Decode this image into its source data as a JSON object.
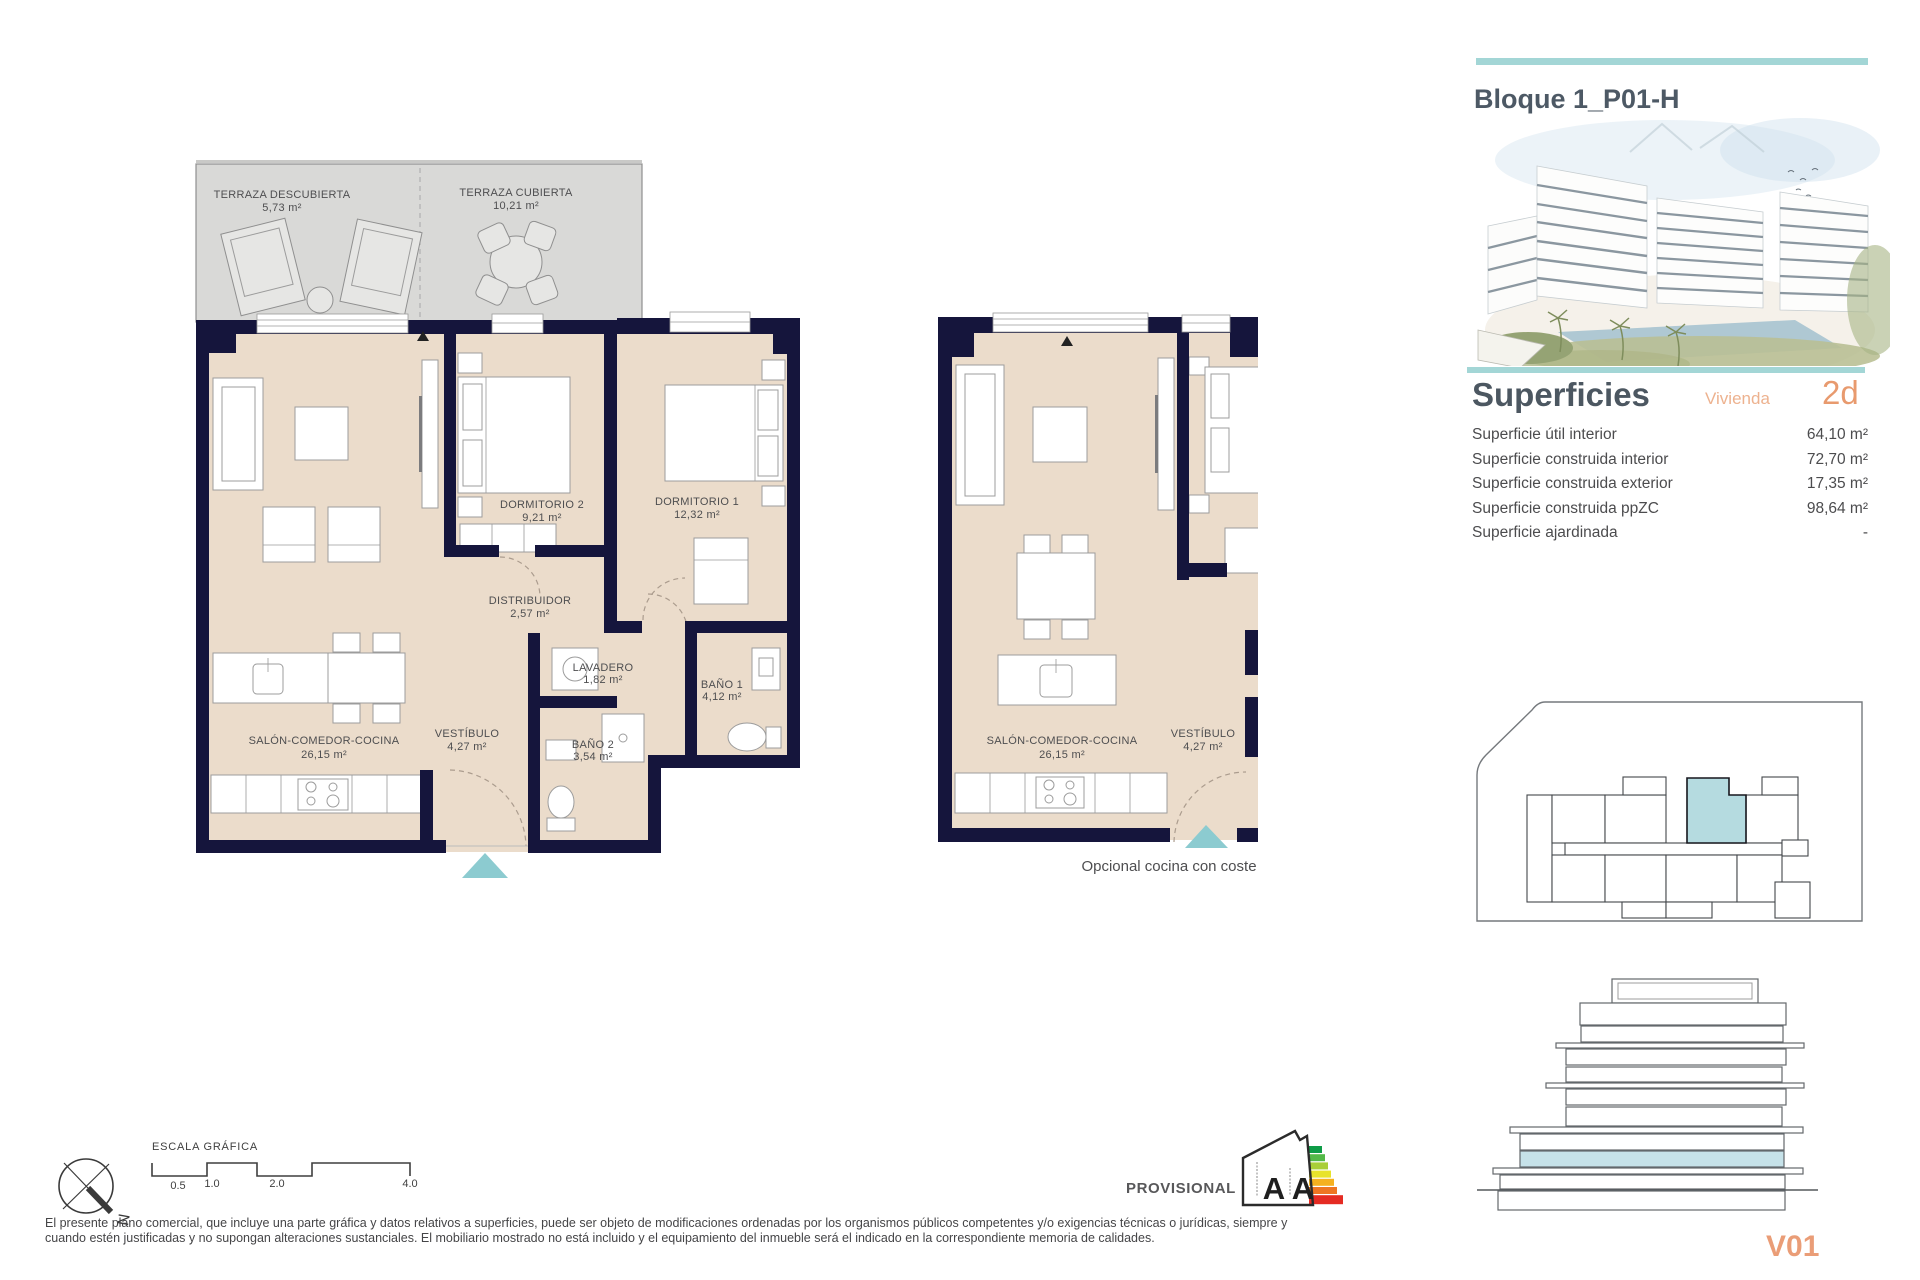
{
  "header": {
    "title": "Bloque 1_P01-H"
  },
  "superficies": {
    "title": "Superficies",
    "vivienda_label": "Vivienda",
    "vivienda_code": "2d",
    "rows": [
      {
        "label": "Superficie útil interior",
        "value": "64,10 m²"
      },
      {
        "label": "Superficie construida interior",
        "value": "72,70 m²"
      },
      {
        "label": "Superficie construida exterior",
        "value": "17,35 m²"
      },
      {
        "label": "Superficie construida ppZC",
        "value": "98,64 m²"
      },
      {
        "label": "Superficie ajardinada",
        "value": "-"
      }
    ]
  },
  "plan_main": {
    "terraza_descubierta": {
      "name": "TERRAZA DESCUBIERTA",
      "area": "5,73 m²"
    },
    "terraza_cubierta": {
      "name": "TERRAZA CUBIERTA",
      "area": "10,21 m²"
    },
    "dormitorio_2": {
      "name": "DORMITORIO 2",
      "area": "9,21 m²"
    },
    "dormitorio_1": {
      "name": "DORMITORIO 1",
      "area": "12,32 m²"
    },
    "distribuidor": {
      "name": "DISTRIBUIDOR",
      "area": "2,57 m²"
    },
    "lavadero": {
      "name": "LAVADERO",
      "area": "1,82 m²"
    },
    "bano_1": {
      "name": "BAÑO 1",
      "area": "4,12 m²"
    },
    "bano_2": {
      "name": "BAÑO 2",
      "area": "3,54 m²"
    },
    "salon": {
      "name": "SALÓN-COMEDOR-COCINA",
      "area": "26,15 m²"
    },
    "vestibulo": {
      "name": "VESTÍBULO",
      "area": "4,27 m²"
    }
  },
  "plan_optional": {
    "salon": {
      "name": "SALÓN-COMEDOR-COCINA",
      "area": "26,15 m²"
    },
    "vestibulo": {
      "name": "VESTÍBULO",
      "area": "4,27 m²"
    },
    "caption": "Opcional cocina con coste"
  },
  "footer": {
    "scale_title": "ESCALA GRÁFICA",
    "scale_ticks": [
      "0.5",
      "1.0",
      "2.0",
      "4.0"
    ],
    "compass_label": "N",
    "provisional": "PROVISIONAL",
    "energy_letters": [
      "A",
      "A"
    ],
    "disclaimer_line1": "El presente plano comercial, que incluye una parte gráfica y datos relativos a superficies, puede ser objeto de modificaciones ordenadas por los organismos públicos competentes y/o exigencias técnicas o jurídicas, siempre y",
    "disclaimer_line2": "cuando estén justificadas y no supongan alteraciones sustanciales. El mobiliario mostrado no está incluido y el equipamiento del inmueble será el indicado en la correspondiente memoria de calidades."
  },
  "version": "V01",
  "colors": {
    "accent_teal": "#a3d6d6",
    "accent_salmon": "#e89a6e",
    "wall_navy": "#15153c",
    "floor_beige": "#ebdccb",
    "highlight_blue": "#b5dbe0"
  }
}
